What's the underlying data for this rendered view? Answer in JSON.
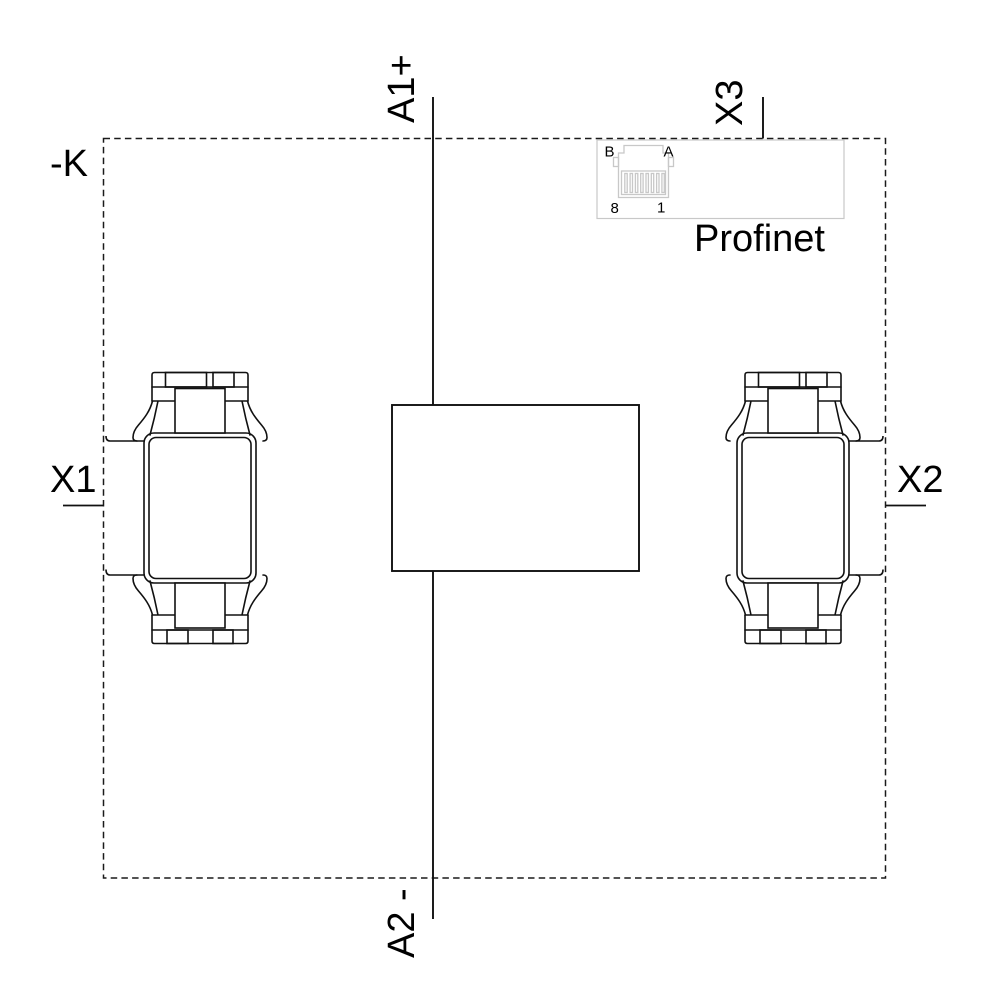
{
  "diagram": {
    "device_tag": "-K",
    "coil_terminal_top": "A1+",
    "coil_terminal_bottom": "A2 -",
    "connector_left": "X1",
    "connector_right": "X2",
    "connector_bus": "X3",
    "bus_name": "Profinet",
    "rj45_labels": {
      "top_left": "B",
      "top_right": "A",
      "bottom_left": "8",
      "bottom_right": "1"
    },
    "colors": {
      "line": "#111111",
      "dashed_border": "#1a1a1a",
      "rj45_gray": "#c8c8c8",
      "background": "#ffffff",
      "text": "#000000"
    }
  }
}
